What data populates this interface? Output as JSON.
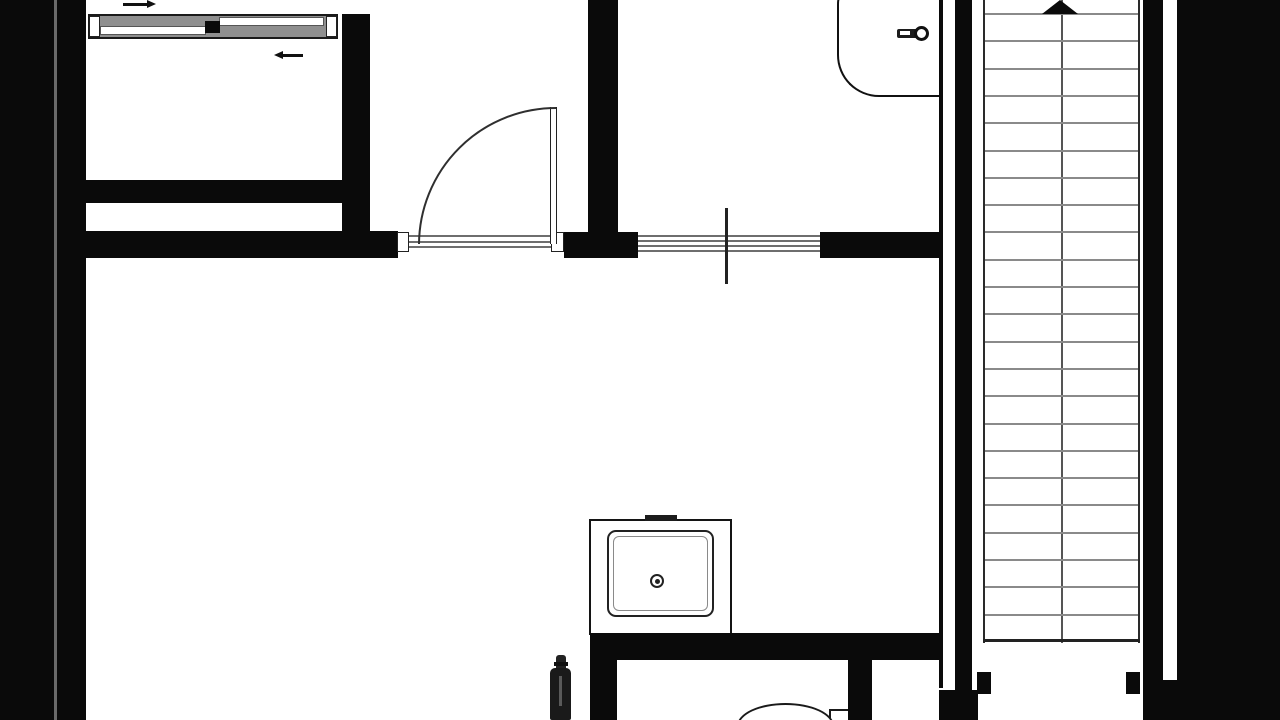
{
  "document": {
    "kind": "architectural-floor-plan",
    "style": "black-and-white line drawing, solid black wall fill"
  },
  "colors": {
    "ink": "#0a0a0a",
    "line_gray": "#6e6e6e",
    "tread_gray": "#8a8a8a",
    "paper": "#ffffff"
  },
  "stairs": {
    "tread_count": 23,
    "first_tread_y": 13,
    "tread_spacing_px": 27.3,
    "direction": "up",
    "arrow_icon": "up-arrow-icon",
    "bottom_edge_y": 640
  },
  "fixtures": [
    {
      "name": "sliding-door",
      "icon": "sliding-door-icon",
      "location": "upper-left-room-top-wall"
    },
    {
      "name": "hinged-door",
      "icon": "door-swing-icon",
      "location": "hallway"
    },
    {
      "name": "interior-window",
      "icon": "window-icon",
      "location": "mid-horizontal-wall"
    },
    {
      "name": "washbasin",
      "icon": "sink-icon",
      "location": "bathroom-upper-right"
    },
    {
      "name": "faucet",
      "icon": "faucet-icon",
      "location": "washbasin"
    },
    {
      "name": "kitchen-sink-unit",
      "icon": "kitchen-sink-icon",
      "location": "lower-middle"
    },
    {
      "name": "toilet",
      "icon": "toilet-icon",
      "location": "bottom-room-partially-cut"
    },
    {
      "name": "bottle-object",
      "icon": "bottle-icon",
      "location": "bottom-edge"
    },
    {
      "name": "staircase",
      "icon": "stairs-icon",
      "location": "right-side"
    }
  ]
}
